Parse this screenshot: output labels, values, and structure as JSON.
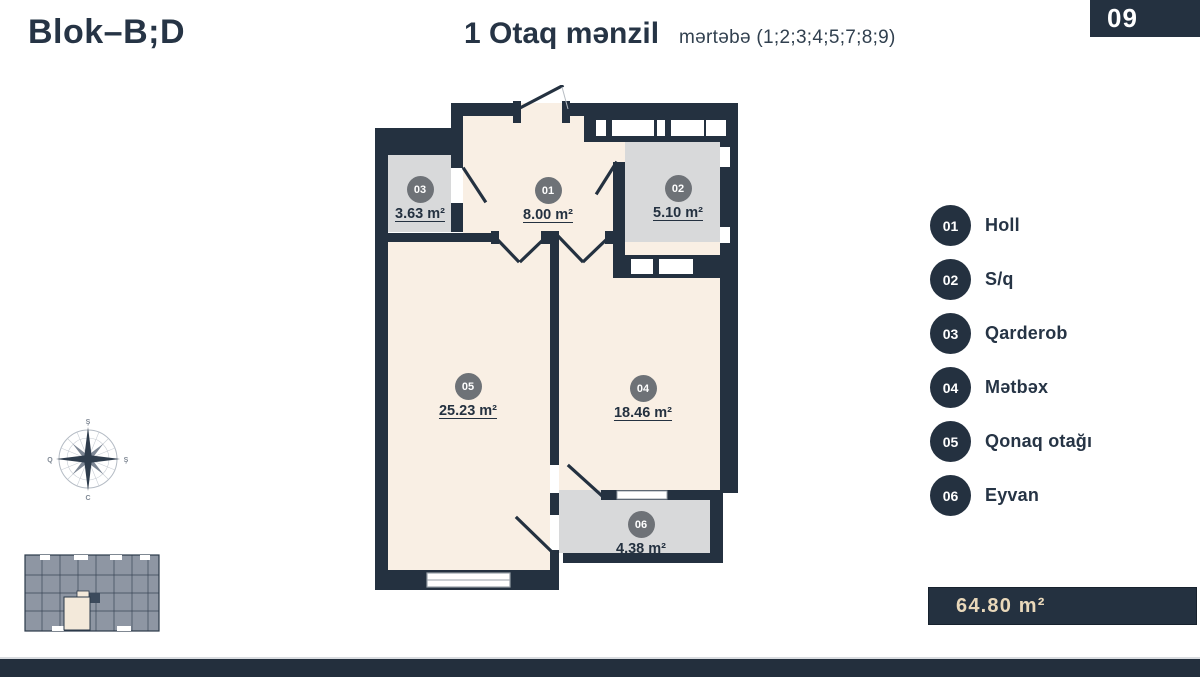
{
  "header": {
    "block_title": "Blok–B;D",
    "plan_title": "1 Otaq mənzil",
    "floors_label": "mərtəbə (1;2;3;4;5;7;8;9)",
    "page_number": "09"
  },
  "plan": {
    "rooms": [
      {
        "num": "01",
        "area": "8.00 m²"
      },
      {
        "num": "02",
        "area": "5.10 m²"
      },
      {
        "num": "03",
        "area": "3.63 m²"
      },
      {
        "num": "04",
        "area": "18.46 m²"
      },
      {
        "num": "05",
        "area": "25.23 m²"
      },
      {
        "num": "06",
        "area": "4.38 m²"
      }
    ]
  },
  "legend": {
    "items": [
      {
        "num": "01",
        "label": "Holl"
      },
      {
        "num": "02",
        "label": "S/q"
      },
      {
        "num": "03",
        "label": "Qarderob"
      },
      {
        "num": "04",
        "label": "Mətbəx"
      },
      {
        "num": "05",
        "label": "Qonaq otağı"
      },
      {
        "num": "06",
        "label": "Eyvan"
      }
    ]
  },
  "compass": {
    "north": "Ş",
    "east": "Ş",
    "south": "C",
    "west": "Q"
  },
  "footer": {
    "total_area": "64.80 m²"
  },
  "colors": {
    "navy": "#243140",
    "cream": "#f9efe4",
    "room_gray": "#d8d9da",
    "label_circle_gray": "#6e7277",
    "area_text_tan": "#e9d8ba",
    "building_gray": "#8e96a3"
  }
}
